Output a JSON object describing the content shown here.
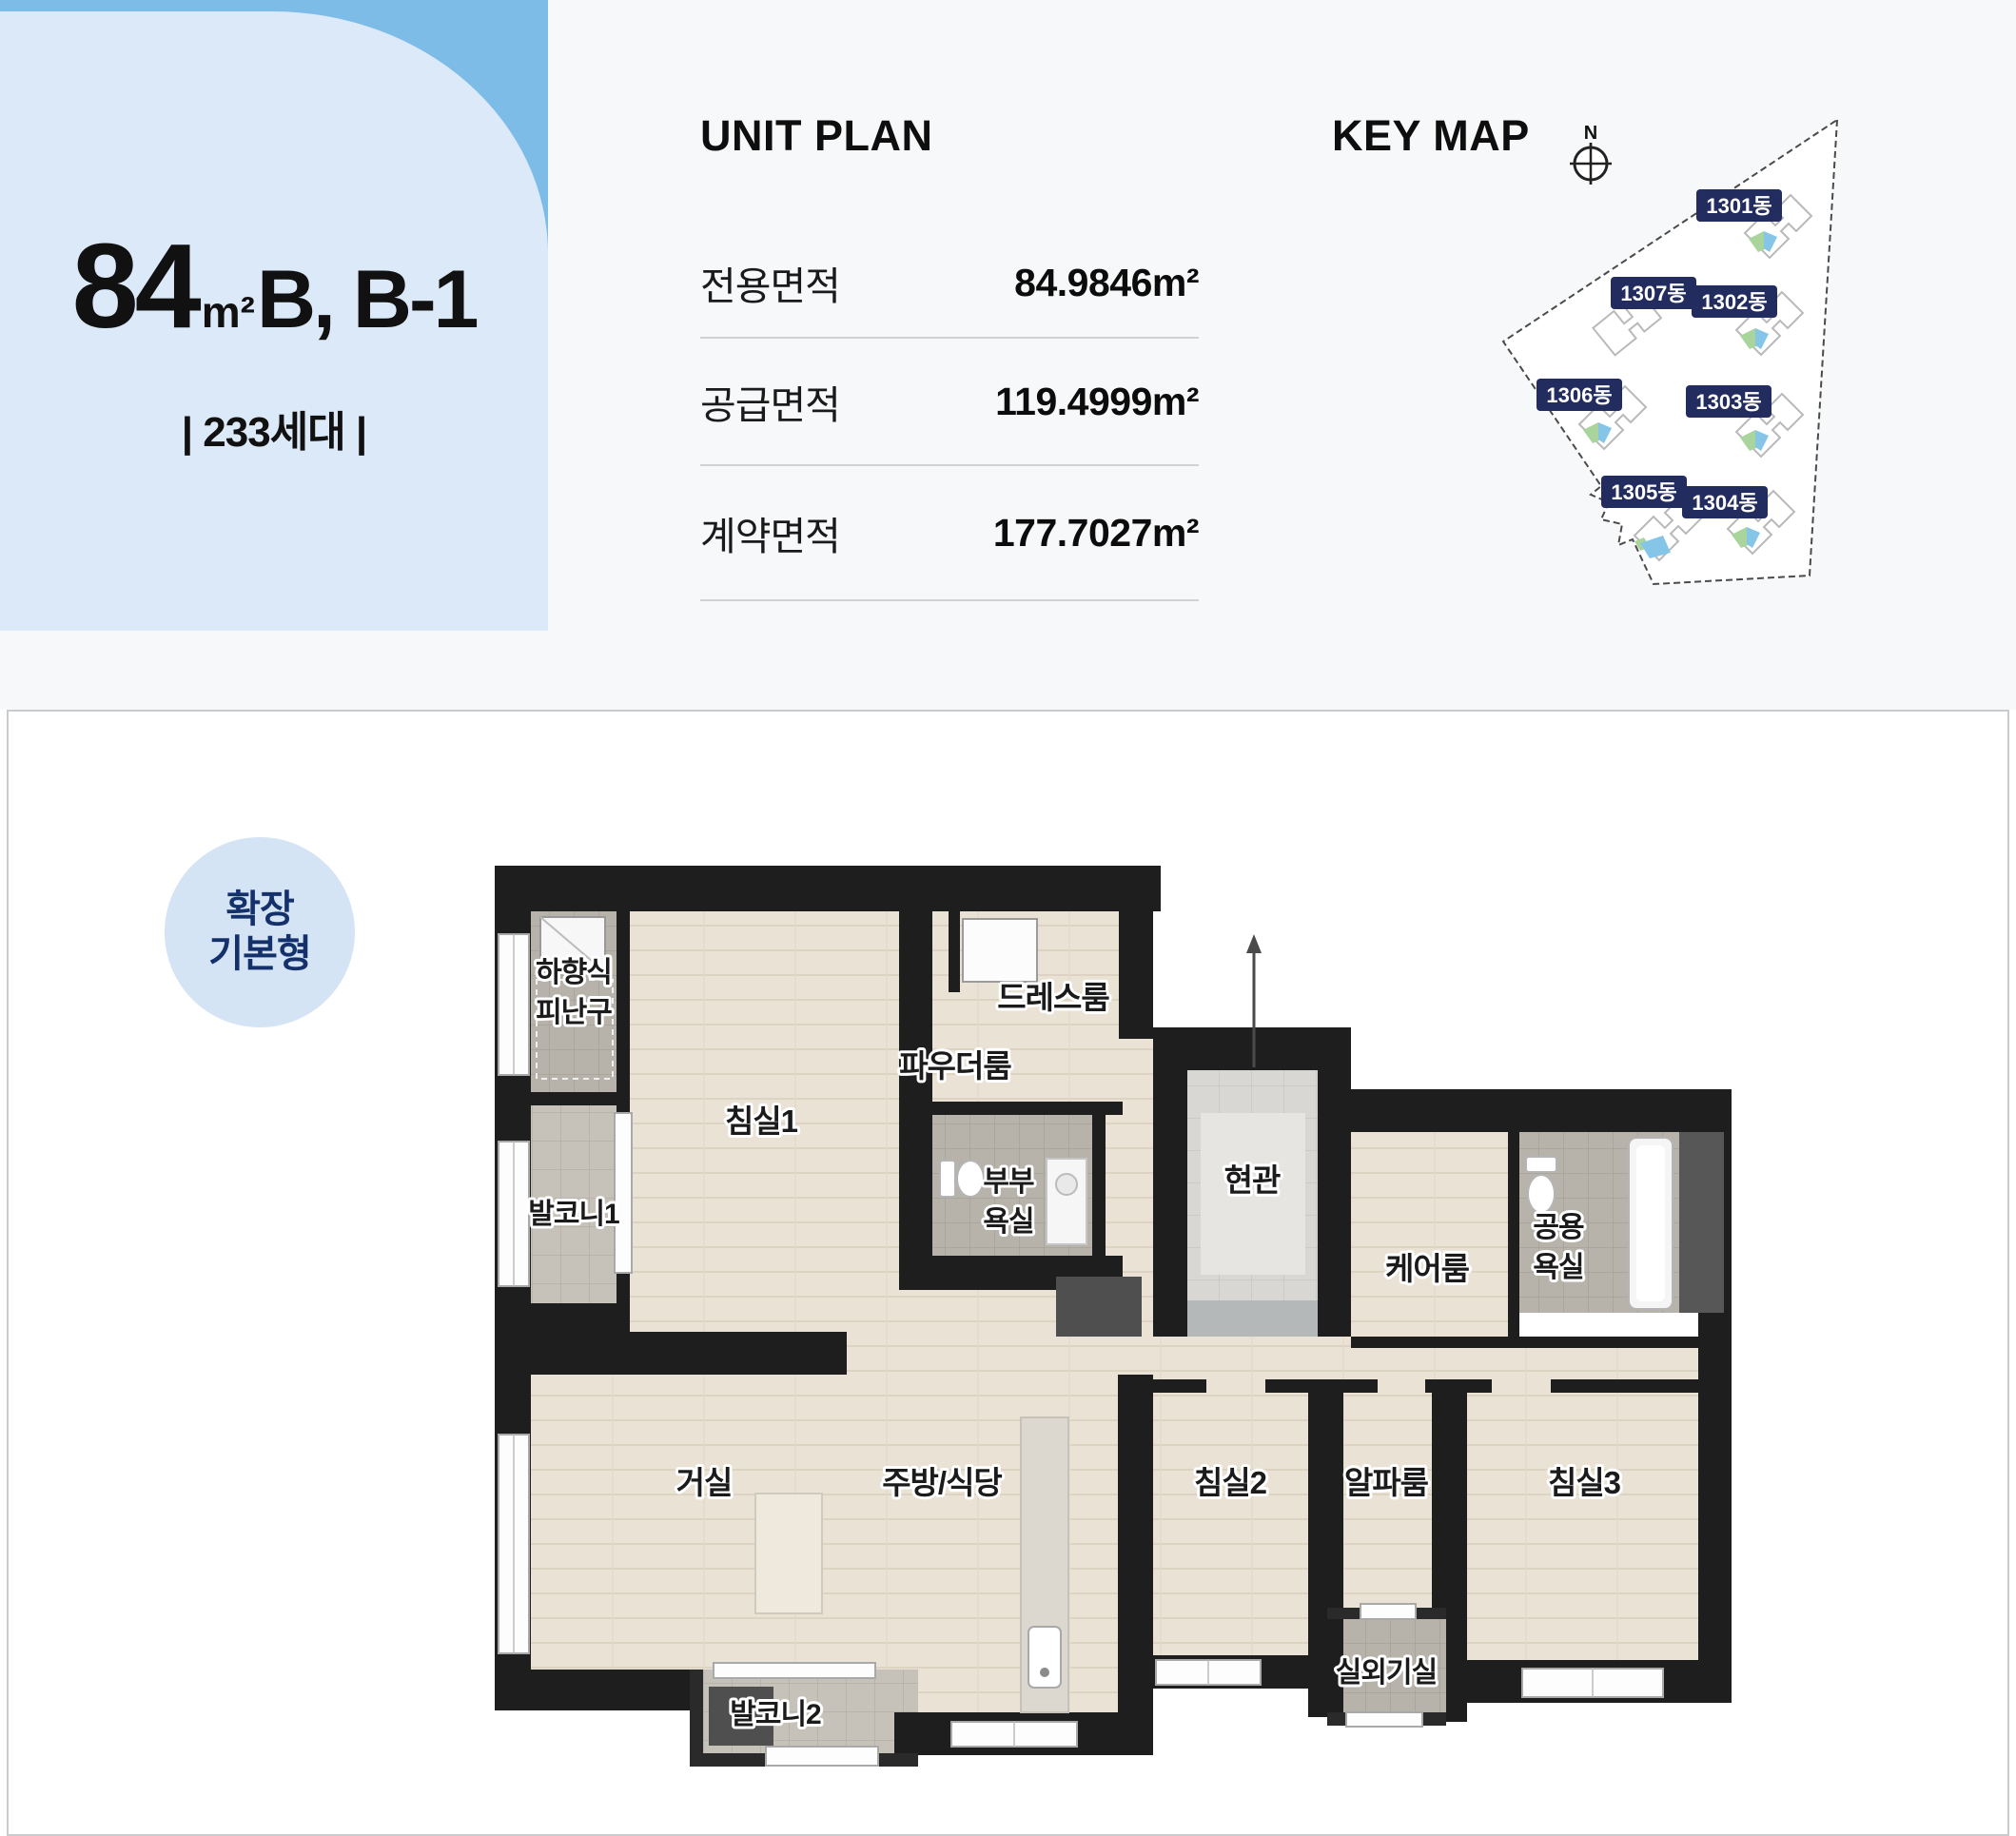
{
  "header_card": {
    "area_number": "84",
    "area_unit": "m²",
    "type_label": "B, B-1",
    "households": "| 233세대 |"
  },
  "unit_plan": {
    "title": "UNIT PLAN",
    "rows": [
      {
        "label": "전용면적",
        "value": "84.9846m²"
      },
      {
        "label": "공급면적",
        "value": "119.4999m²"
      },
      {
        "label": "계약면적",
        "value": "177.7027m²"
      }
    ]
  },
  "key_map": {
    "title": "KEY MAP",
    "compass_label": "N",
    "buildings": [
      {
        "label": "1301동"
      },
      {
        "label": "1307동"
      },
      {
        "label": "1302동"
      },
      {
        "label": "1306동"
      },
      {
        "label": "1303동"
      },
      {
        "label": "1305동"
      },
      {
        "label": "1304동"
      }
    ]
  },
  "floor_plan": {
    "variant_badge": {
      "line1": "확장",
      "line2": "기본형"
    },
    "rooms": {
      "escape_line1": "하향식",
      "escape_line2": "피난구",
      "balcony1": "발코니1",
      "bedroom1": "침실1",
      "powder": "파우더룸",
      "dress": "드레스룸",
      "master_bath_line1": "부부",
      "master_bath_line2": "욕실",
      "entrance": "현관",
      "care": "케어룸",
      "common_bath_line1": "공용",
      "common_bath_line2": "욕실",
      "living": "거실",
      "kitchen": "주방/식당",
      "bedroom2": "침실2",
      "alpha": "알파룸",
      "bedroom3": "침실3",
      "outdoor_unit": "실외기실",
      "balcony2": "발코니2"
    }
  },
  "colors": {
    "accent_blue": "#7cbce7",
    "card_bg": "#dce9f8",
    "badge_navy": "#222c5e",
    "highlight_green": "#a9d49c",
    "highlight_blue": "#85c6e8",
    "wall": "#1e1e1e",
    "wood_floor": "#eae2d4",
    "tile_gray": "#b7b3ab"
  }
}
